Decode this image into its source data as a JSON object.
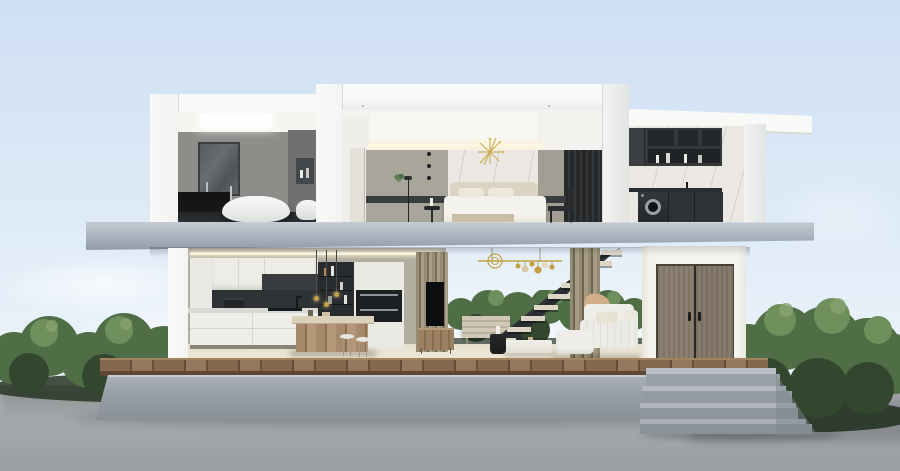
{
  "scene": {
    "title": "3D cutaway cross-section render of a modern two-story house",
    "environment": [
      "clear light-blue sky",
      "soft clouds",
      "green hedges",
      "gray concrete ground",
      "raised concrete platform with wooden deck edge",
      "concrete entry steps"
    ]
  },
  "palette": {
    "sky_top": "#cfe0f3",
    "sky_mid": "#ddeaf7",
    "sky_low": "#eef4fb",
    "ground_hi": "#b7babd",
    "ground": "#a7aaad",
    "ground_lo": "#9b9ea1",
    "ground_shadow": "#70757a",
    "bush_dark": "#33472f",
    "bush_mid": "#4f6e45",
    "bush_light": "#6f8f5c",
    "bush_hi": "#87a46f",
    "bush_base": "#263423",
    "shell": "#f3f4f2",
    "shell_hi": "#f9faf8",
    "shell_shade": "#e2e4e2",
    "shell_edge": "#d6d8d6",
    "slab_hi": "#c3cad2",
    "slab": "#a8b1bd",
    "slab_lo": "#919ba8",
    "concrete_hi": "#b9bfc5",
    "concrete": "#98a0a7",
    "concrete_lo": "#8a9299",
    "deck": "#85684e",
    "deck_dark": "#5e4634",
    "deck_hi": "#a2835f",
    "floor": "#e6dfce",
    "floor_hi": "#f0e9da",
    "greige": "#b1ada0",
    "bath_wall": "#8d8d8a",
    "bath_dark": "#6e7071",
    "charcoal": "#2e3134",
    "ink": "#17191b",
    "marble": "#ebe8e3",
    "olive": "#948a72",
    "olive_dark": "#6e6550",
    "gold": "#c2a144",
    "bedwall": "#a8a59b",
    "linen": "#f4f2ec",
    "headboard": "#dbd4c3",
    "wood": "#a08264",
    "wood_dark": "#7c614a",
    "door": "#8b8072",
    "door_frame": "#474338",
    "steel": "#9aa0a6",
    "glow": "#fdf6e2"
  },
  "rooms": {
    "bathroom": {
      "label": "bathroom",
      "items": [
        "ceiling light panel",
        "wall art",
        "dark vanity counter",
        "freestanding bathtub",
        "toilet",
        "shelf niche"
      ]
    },
    "bedroom": {
      "label": "bedroom",
      "items": [
        "cove ceiling",
        "marble headboard wall",
        "gold starburst decor",
        "double bed",
        "pillows",
        "foot bench",
        "nightstand",
        "floor lamp",
        "black chair",
        "dark curtain"
      ]
    },
    "laundry": {
      "label": "laundry room",
      "items": [
        "dark upper cabinets with shelves",
        "marble backsplash",
        "washing machine",
        "dark base cabinets"
      ]
    },
    "kitchen": {
      "label": "kitchen",
      "items": [
        "white wall cabinets",
        "dark backsplash",
        "base cabinets",
        "coffee machine",
        "cooktop",
        "display shelf with bottles",
        "built-in double oven",
        "wooden island table",
        "stools",
        "pendant lights"
      ]
    },
    "living_room": {
      "label": "living room",
      "items": [
        "glass wall with garden view",
        "floating staircase",
        "gold chandelier",
        "white sofa",
        "throw blanket",
        "coffee table",
        "black side table",
        "slatted sideboard",
        "TV",
        "wood TV console",
        "olive curtains"
      ]
    },
    "entrance": {
      "label": "entrance",
      "items": [
        "white exterior wall",
        "double wooden door",
        "door handles",
        "wood deck",
        "concrete steps"
      ]
    }
  }
}
